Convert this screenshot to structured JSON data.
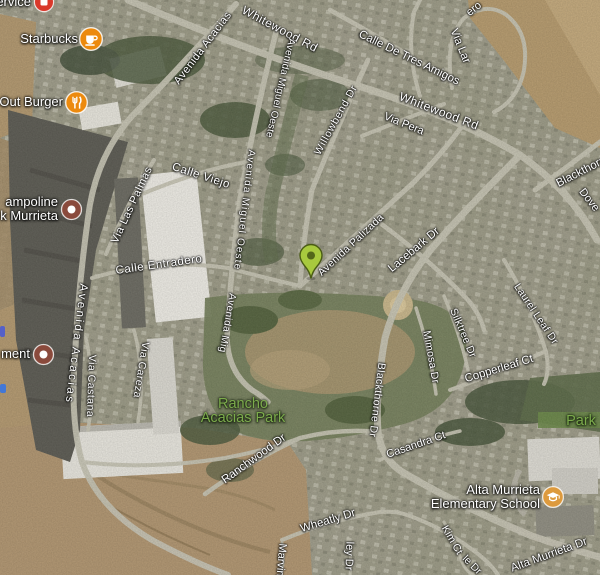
{
  "map": {
    "kind": "satellite",
    "marker": {
      "label": "green-location-pin",
      "x": 311,
      "y": 279,
      "color": "#a8c93e",
      "dot_color": "#53661a",
      "outline": "#4a5c14"
    },
    "pois": [
      {
        "name": "service-label-partial",
        "lines": [
          "ervice"
        ],
        "icon": "red-box",
        "icon_color": "#d9392b",
        "ix": 44,
        "iy": 2
      },
      {
        "name": "starbucks",
        "lines": [
          "Starbucks"
        ],
        "icon": "coffee",
        "icon_color": "#ec8a0e",
        "ix": 91,
        "iy": 39
      },
      {
        "name": "in-n-out-burger-partial",
        "lines": [
          "Out Burger"
        ],
        "icon": "restaurant",
        "icon_color": "#ec8a0e",
        "ix": 76,
        "iy": 102
      },
      {
        "name": "trampoline-park-murrieta-partial",
        "lines": [
          "ampoline",
          "k Murrieta"
        ],
        "icon": "dot",
        "icon_color": "#8a4a3c",
        "ix": 71,
        "iy": 209
      },
      {
        "name": "ment-label-partial",
        "lines": [
          "ment"
        ],
        "icon": "dot",
        "icon_color": "#8a4a3c",
        "ix": 43,
        "iy": 354
      },
      {
        "name": "alta-murrieta-elementary-school",
        "lines": [
          "Alta Murrieta",
          "Elementary School"
        ],
        "icon": "school",
        "icon_color": "#dd9a3d",
        "ix": 553,
        "iy": 497
      }
    ],
    "parks": [
      {
        "name": "rancho-acacias-park",
        "lines": [
          "Rancho",
          "Acacias Park"
        ],
        "x": 243,
        "y": 411
      },
      {
        "name": "park-label-partial",
        "lines": [
          "Park"
        ],
        "x": 581,
        "y": 421
      }
    ],
    "streets": [
      {
        "t": "Whitewood Rd",
        "x": 280,
        "y": 29,
        "r": 28,
        "s": 12,
        "ls": 0.5
      },
      {
        "t": "ero",
        "x": 474,
        "y": 9,
        "r": -38,
        "s": 11
      },
      {
        "t": "Calle De Tres Amigos",
        "x": 409,
        "y": 58,
        "r": 26,
        "s": 11.5
      },
      {
        "t": "Via Lar",
        "x": 460,
        "y": 46,
        "r": 68,
        "s": 11.5
      },
      {
        "t": "Whitewood Rd",
        "x": 439,
        "y": 111,
        "r": 21,
        "s": 12,
        "ls": 0.5
      },
      {
        "t": "Via Pera",
        "x": 404,
        "y": 124,
        "r": 22,
        "s": 11
      },
      {
        "t": "Willowbend Dr",
        "x": 336,
        "y": 120,
        "r": -61,
        "s": 10.5,
        "ls": 0.8
      },
      {
        "t": "Avenida Miguel Oeste",
        "x": 280,
        "y": 88,
        "r": 103,
        "s": 10,
        "ls": 0.2
      },
      {
        "t": "Avenida Acacias",
        "x": 203,
        "y": 48,
        "r": -53,
        "s": 11,
        "ls": 0.5
      },
      {
        "t": "Calle Viejo",
        "x": 201,
        "y": 176,
        "r": 18,
        "s": 11.5,
        "ls": 0.5
      },
      {
        "t": "Via Las Palmas",
        "x": 132,
        "y": 205,
        "r": -65,
        "s": 11,
        "ls": 0.5
      },
      {
        "t": "Calle Entradero",
        "x": 159,
        "y": 265,
        "r": -8,
        "s": 11.5,
        "ls": 0.5
      },
      {
        "t": "Avenida Miguel Oeste",
        "x": 244,
        "y": 210,
        "r": 97,
        "s": 10,
        "ls": 1.2
      },
      {
        "t": "Avenida Mig",
        "x": 227,
        "y": 323,
        "r": 100,
        "s": 10,
        "ls": 0.5
      },
      {
        "t": "Avenida Acacias",
        "x": 76,
        "y": 344,
        "r": 97,
        "s": 11.5,
        "ls": 2.5
      },
      {
        "t": "Via Castana",
        "x": 91,
        "y": 386,
        "r": 92,
        "s": 10.5,
        "ls": 0.5
      },
      {
        "t": "Via Careza",
        "x": 141,
        "y": 370,
        "r": 99,
        "s": 10.5,
        "ls": 0.5
      },
      {
        "t": "Avenida Palizada",
        "x": 351,
        "y": 245,
        "r": -43,
        "s": 10.5,
        "ls": 0.3
      },
      {
        "t": "Lacebark Dr",
        "x": 414,
        "y": 250,
        "r": -40,
        "s": 11.5
      },
      {
        "t": "Blackthorne Dr",
        "x": 591,
        "y": 167,
        "r": -27,
        "s": 11.5
      },
      {
        "t": "Dove",
        "x": 589,
        "y": 200,
        "r": 52,
        "s": 11
      },
      {
        "t": "Laurel Leaf Dr",
        "x": 536,
        "y": 314,
        "r": 56,
        "s": 10.5,
        "ls": 0.3
      },
      {
        "t": "Silktree Dr",
        "x": 463,
        "y": 333,
        "r": 67,
        "s": 10.5,
        "ls": 0.3
      },
      {
        "t": "Mimosa Dr",
        "x": 431,
        "y": 357,
        "r": 80,
        "s": 10.5,
        "ls": 0.3
      },
      {
        "t": "Copperleaf Ct",
        "x": 499,
        "y": 369,
        "r": -17,
        "s": 11.5
      },
      {
        "t": "Blackthorne Dr",
        "x": 377,
        "y": 400,
        "r": 97,
        "s": 10.5,
        "ls": 0.4
      },
      {
        "t": "Ranchwood Dr",
        "x": 254,
        "y": 459,
        "r": -36,
        "s": 11.5
      },
      {
        "t": "Casandra Ct",
        "x": 416,
        "y": 445,
        "r": -19,
        "s": 11
      },
      {
        "t": "Wheatly Dr",
        "x": 328,
        "y": 521,
        "r": -17,
        "s": 11.5
      },
      {
        "t": "Marvin",
        "x": 281,
        "y": 560,
        "r": 95,
        "s": 11
      },
      {
        "t": "ley Dr",
        "x": 349,
        "y": 556,
        "r": 92,
        "s": 11
      },
      {
        "t": "Kim Ct",
        "x": 452,
        "y": 540,
        "r": 60,
        "s": 10.5
      },
      {
        "t": "le Dr",
        "x": 472,
        "y": 565,
        "r": 45,
        "s": 10.5
      },
      {
        "t": "Alta Murrieta Dr",
        "x": 549,
        "y": 555,
        "r": -20,
        "s": 11.5
      }
    ],
    "edge_fragments": [
      {
        "x": 0,
        "y": 326,
        "w": 5,
        "h": 11,
        "color": "#5560c8"
      },
      {
        "x": 0,
        "y": 384,
        "w": 6,
        "h": 9,
        "color": "#4277d6"
      }
    ]
  },
  "colors": {
    "street_label": "#ffffff",
    "park_label": "#7cab4c",
    "poi_orange": "#ec8a0e",
    "poi_maroon": "#8a4a3c",
    "poi_red": "#d9392b",
    "school_icon": "#dd9a3d",
    "pin_green": "#a8c93e"
  }
}
